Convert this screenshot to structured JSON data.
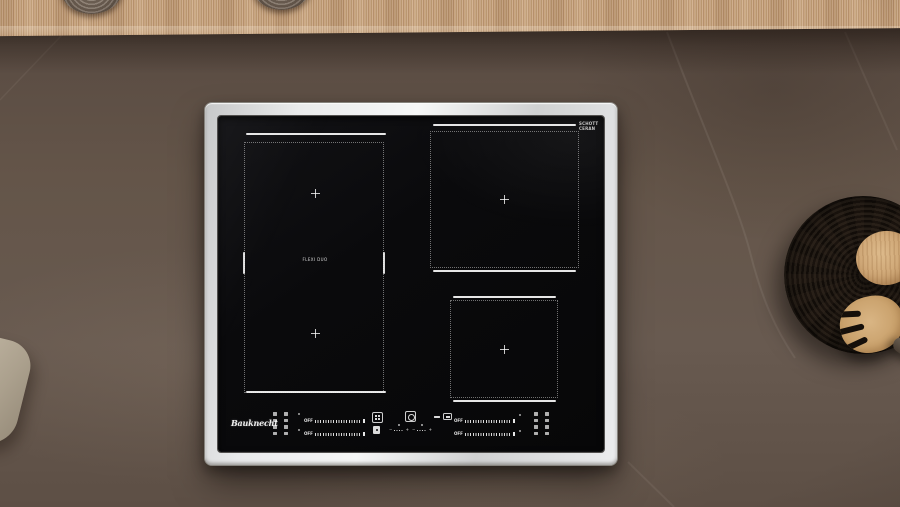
{
  "hob": {
    "brand_logo": "Bauknecht",
    "glass_brand_line1": "SCHOTT",
    "glass_brand_line2": "CERAN",
    "flex_zone_label": "FLEXI DUO",
    "controls": {
      "off_label": "OFF",
      "minus": "−",
      "plus": "+"
    }
  },
  "colors": {
    "counter": "#61534a",
    "wood_shelf": "#c2a182",
    "hob_glass": "#0a0a0c",
    "hob_frame": "#d8d9da",
    "zone_marking": "#fafafa",
    "trivet": "#1c1613",
    "wooden_utensils": "#c9a06a",
    "towel": "#b2a795"
  }
}
